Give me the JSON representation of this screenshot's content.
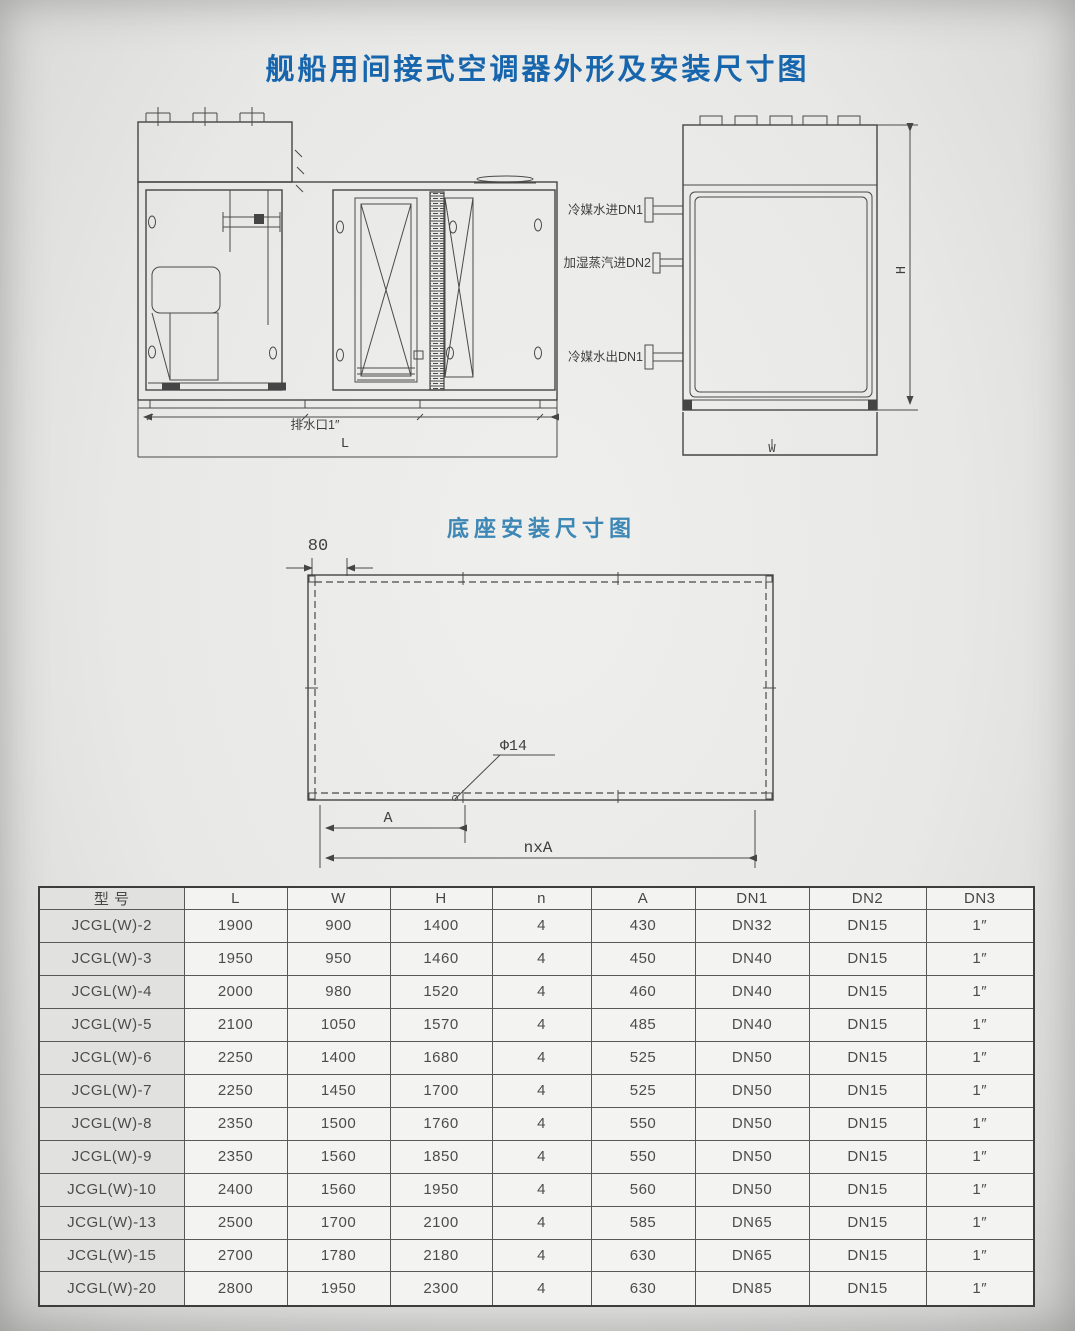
{
  "page": {
    "title": "舰船用间接式空调器外形及安装尺寸图"
  },
  "colors": {
    "title_blue": "#1766ad",
    "section_blue": "#3d87b5",
    "ink": "#454545",
    "paper": "#e8e8e6"
  },
  "front_view": {
    "drain_label": "排水口1″",
    "length_label": "L"
  },
  "side_view": {
    "inlet_label": "冷媒水进DN1",
    "steam_label": "加湿蒸汽进DN2",
    "outlet_label": "冷媒水出DN1",
    "height_label": "H",
    "width_label": "W"
  },
  "base_diagram": {
    "title": "底座安装尺寸图",
    "edge_dim": "80",
    "hole_label": "Φ14",
    "pitch_label": "A",
    "span_label": "nxA"
  },
  "table": {
    "headers": [
      "型 号",
      "L",
      "W",
      "H",
      "n",
      "A",
      "DN1",
      "DN2",
      "DN3"
    ],
    "rows": [
      [
        "JCGL(W)-2",
        "1900",
        "900",
        "1400",
        "4",
        "430",
        "DN32",
        "DN15",
        "1″"
      ],
      [
        "JCGL(W)-3",
        "1950",
        "950",
        "1460",
        "4",
        "450",
        "DN40",
        "DN15",
        "1″"
      ],
      [
        "JCGL(W)-4",
        "2000",
        "980",
        "1520",
        "4",
        "460",
        "DN40",
        "DN15",
        "1″"
      ],
      [
        "JCGL(W)-5",
        "2100",
        "1050",
        "1570",
        "4",
        "485",
        "DN40",
        "DN15",
        "1″"
      ],
      [
        "JCGL(W)-6",
        "2250",
        "1400",
        "1680",
        "4",
        "525",
        "DN50",
        "DN15",
        "1″"
      ],
      [
        "JCGL(W)-7",
        "2250",
        "1450",
        "1700",
        "4",
        "525",
        "DN50",
        "DN15",
        "1″"
      ],
      [
        "JCGL(W)-8",
        "2350",
        "1500",
        "1760",
        "4",
        "550",
        "DN50",
        "DN15",
        "1″"
      ],
      [
        "JCGL(W)-9",
        "2350",
        "1560",
        "1850",
        "4",
        "550",
        "DN50",
        "DN15",
        "1″"
      ],
      [
        "JCGL(W)-10",
        "2400",
        "1560",
        "1950",
        "4",
        "560",
        "DN50",
        "DN15",
        "1″"
      ],
      [
        "JCGL(W)-13",
        "2500",
        "1700",
        "2100",
        "4",
        "585",
        "DN65",
        "DN15",
        "1″"
      ],
      [
        "JCGL(W)-15",
        "2700",
        "1780",
        "2180",
        "4",
        "630",
        "DN65",
        "DN15",
        "1″"
      ],
      [
        "JCGL(W)-20",
        "2800",
        "1950",
        "2300",
        "4",
        "630",
        "DN85",
        "DN15",
        "1″"
      ]
    ]
  }
}
